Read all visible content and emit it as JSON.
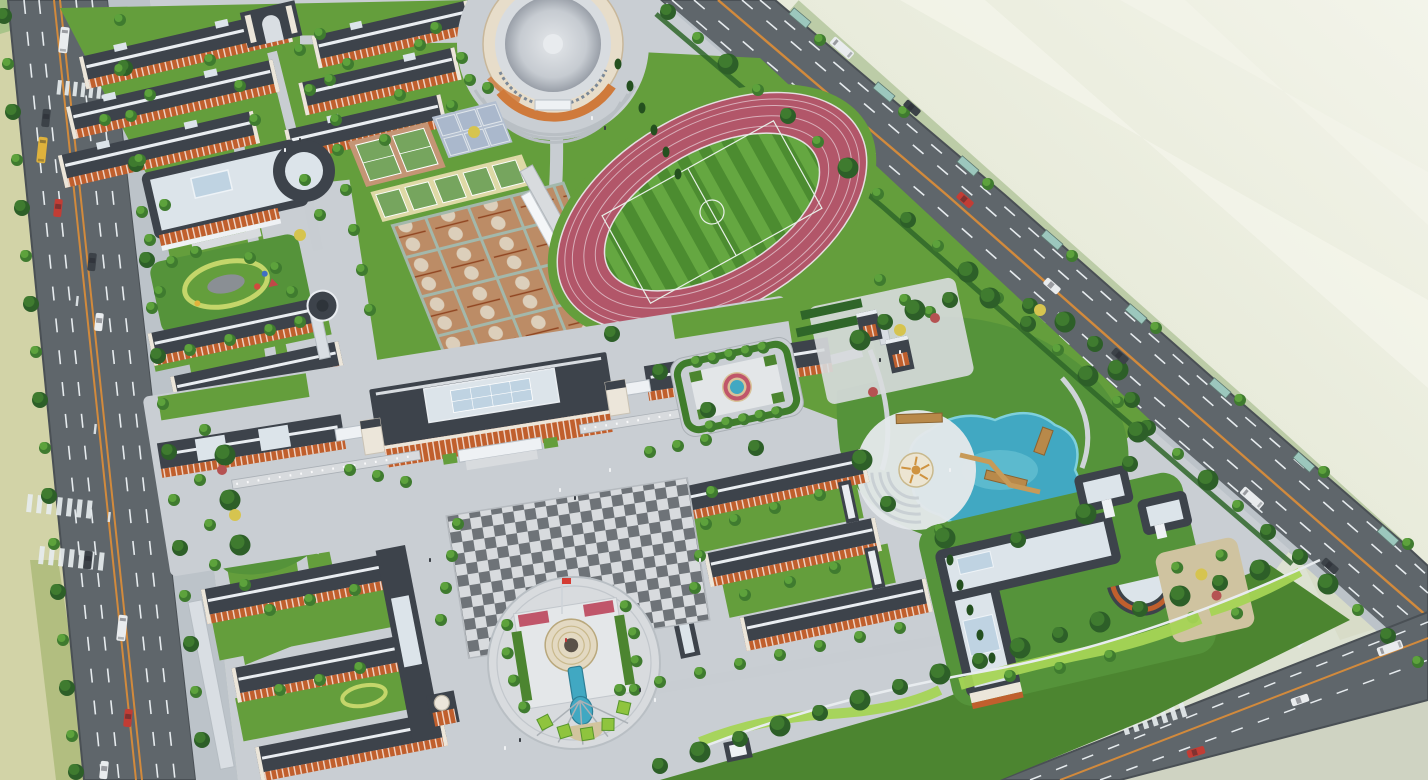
{
  "scene": {
    "description": "Aerial bird's-eye architectural rendering of a school campus master plan: red-brick dormitory and classroom buildings with dark roofs, a round gymnasium, running track with football pitch, basketball and tennis courts, central academic building, checkered plaza, circular fountain plaza, landscaped pond garden with amphitheater, library with curved wing, bordered by tree-lined city roads and empty farmland."
  },
  "zones": [
    {
      "name": "city-road-west",
      "kind": "road"
    },
    {
      "name": "city-road-northeast",
      "kind": "road"
    },
    {
      "name": "city-road-southeast",
      "kind": "road"
    },
    {
      "name": "farmland-west",
      "kind": "terrain"
    },
    {
      "name": "vacant-land-northeast",
      "kind": "terrain"
    },
    {
      "name": "dormitory-cluster",
      "kind": "buildings"
    },
    {
      "name": "north-gate",
      "kind": "gate"
    },
    {
      "name": "dining-hall",
      "kind": "building"
    },
    {
      "name": "gymnasium-auditorium",
      "kind": "building"
    },
    {
      "name": "tennis-courts",
      "kind": "sports"
    },
    {
      "name": "volleyball-courts",
      "kind": "sports"
    },
    {
      "name": "basketball-courts",
      "kind": "sports"
    },
    {
      "name": "running-track-and-pitch",
      "kind": "sports"
    },
    {
      "name": "grandstand",
      "kind": "structure"
    },
    {
      "name": "main-academic-building",
      "kind": "building"
    },
    {
      "name": "checkered-plaza",
      "kind": "plaza"
    },
    {
      "name": "fountain-plaza",
      "kind": "plaza"
    },
    {
      "name": "flag-pole",
      "kind": "landmark"
    },
    {
      "name": "west-classroom-pair",
      "kind": "buildings"
    },
    {
      "name": "southwest-courtyard-complex",
      "kind": "buildings"
    },
    {
      "name": "east-classroom-complex",
      "kind": "buildings"
    },
    {
      "name": "east-gate-towers",
      "kind": "gate"
    },
    {
      "name": "parterre-fountain-garden",
      "kind": "garden"
    },
    {
      "name": "landscape-pond-garden",
      "kind": "garden"
    },
    {
      "name": "amphitheater",
      "kind": "structure"
    },
    {
      "name": "library-curved-wing",
      "kind": "building"
    },
    {
      "name": "reading-garden",
      "kind": "garden"
    },
    {
      "name": "west-gardens",
      "kind": "garden"
    },
    {
      "name": "south-green-belt",
      "kind": "garden"
    }
  ],
  "counts": {
    "running_track_lanes": 6,
    "basketball_courts": 16,
    "tennis_courts_north": 2,
    "tennis_courts_south": 5,
    "volleyball_courts": 6
  },
  "palette": {
    "bg": "#dde2d2",
    "land-far": "#eff0e4",
    "land-band": "#f7f7ee",
    "field-left": "#d2d3a7",
    "field-band": "#c0c99b",
    "grass-corner": "#a8c489",
    "road": "#5f666b",
    "road-edge": "#4a5055",
    "lane-orange": "#d28a3c",
    "lane-white": "#e6ebee",
    "sidewalk": "#bcc3c9",
    "paving": "#c9ced3",
    "paving-light": "#d8dbde",
    "plaza-dark": "#6e7378",
    "lawn": "#649e3c",
    "lawn-dark": "#4c8530",
    "pitch-dark": "#4c8c30",
    "pitch-light": "#65a741",
    "tree-dark": "#2d5f28",
    "tree-mid": "#3f7b2f",
    "tree-light": "#5da23c",
    "cypress": "#24501f",
    "shrub-yellow": "#d6c44f",
    "shrub-red": "#b55252",
    "hedge": "#2f6629",
    "hedge-lime": "#a5d455",
    "track": "#b25669",
    "track-lane": "#d9aeb9",
    "court-tan": "#c49575",
    "court-cell": "#bc8c66",
    "court-light": "#dccfbb",
    "court-green": "#76a55e",
    "court-sand": "#ded9a6",
    "court-blue": "#b3bfd0",
    "court-grid": "#a3b8ab",
    "roof-dark": "#3d434b",
    "roof-darker": "#2e343a",
    "roof-ridge": "#e9edf1",
    "roof-flat": "#dce4ea",
    "skylight": "#bfd3e2",
    "brick": "#c05f2d",
    "brick-shadow": "#8f431f",
    "trim-white": "#ece6da",
    "canopy": "#eef1f4",
    "dome-mid": "#c6cbd1",
    "gym-band-orange": "#cf7a3b",
    "gym-facade": "#e7ddca",
    "water": "#41a8c2",
    "water-light": "#7fd0dd",
    "water-deep": "#2e7f96",
    "pool-sand": "#dcc493",
    "amphi-stone": "#e4e8ea",
    "amphi-ring": "#c9d0d4",
    "sun-motif": "#cf9340",
    "deck-wood": "#b8894a",
    "flower-red": "#c0566a",
    "planter-green": "#8fc43e",
    "fountain-tan": "#d8c298",
    "bus-yellow": "#dfb23c",
    "car-red": "#c23d35",
    "car-white": "#e9ecee",
    "car-dark": "#3c4248",
    "shelter-teal": "#9cc7bd",
    "flag-red": "#d43c33",
    "people-dark": "#3a3f45",
    "people-light": "#f0f2f4"
  }
}
